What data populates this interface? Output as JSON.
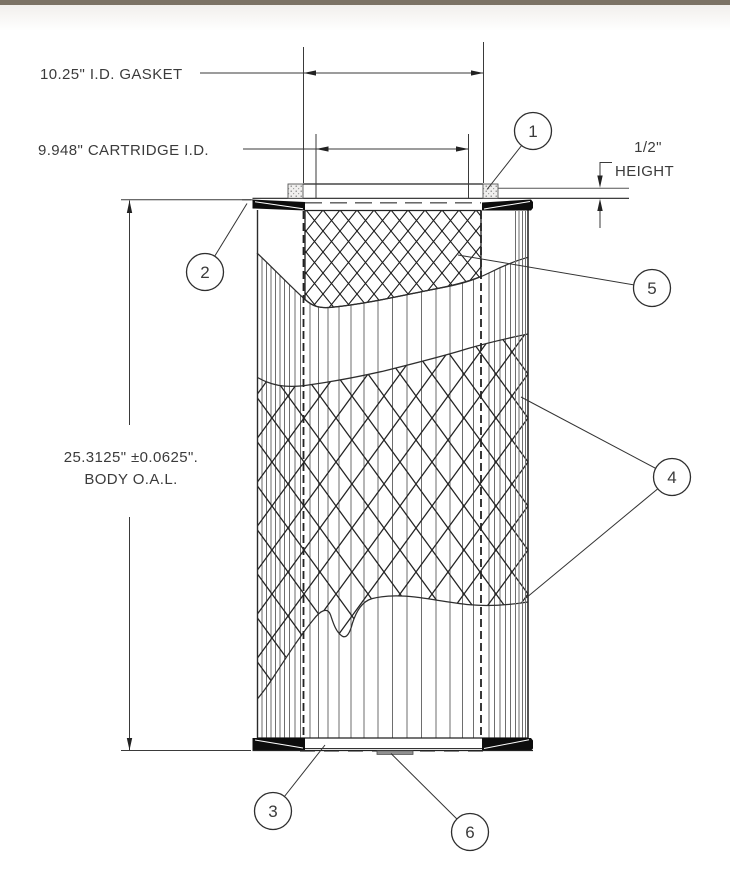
{
  "window": {
    "chrome_bar": "present"
  },
  "colors": {
    "chrome": "#7b7264",
    "line": "#1f1f1f",
    "pleat": "#6e6e6e",
    "dim_text": "#3b3b3b"
  },
  "drawing": {
    "type": "engineering-cross-section",
    "subject": "pleated filter cartridge",
    "dimensions": {
      "gasket_id": "10.25\" I.D. GASKET",
      "cartridge_id": "9.948\" CARTRIDGE I.D.",
      "body_oal_line1": "25.3125\" ±0.0625\".",
      "body_oal_line2": "BODY O.A.L.",
      "gasket_height_value": "1/2\"",
      "gasket_height_label": "HEIGHT"
    },
    "callouts": [
      {
        "number": "1"
      },
      {
        "number": "2"
      },
      {
        "number": "3"
      },
      {
        "number": "4"
      },
      {
        "number": "5"
      },
      {
        "number": "6"
      }
    ]
  }
}
